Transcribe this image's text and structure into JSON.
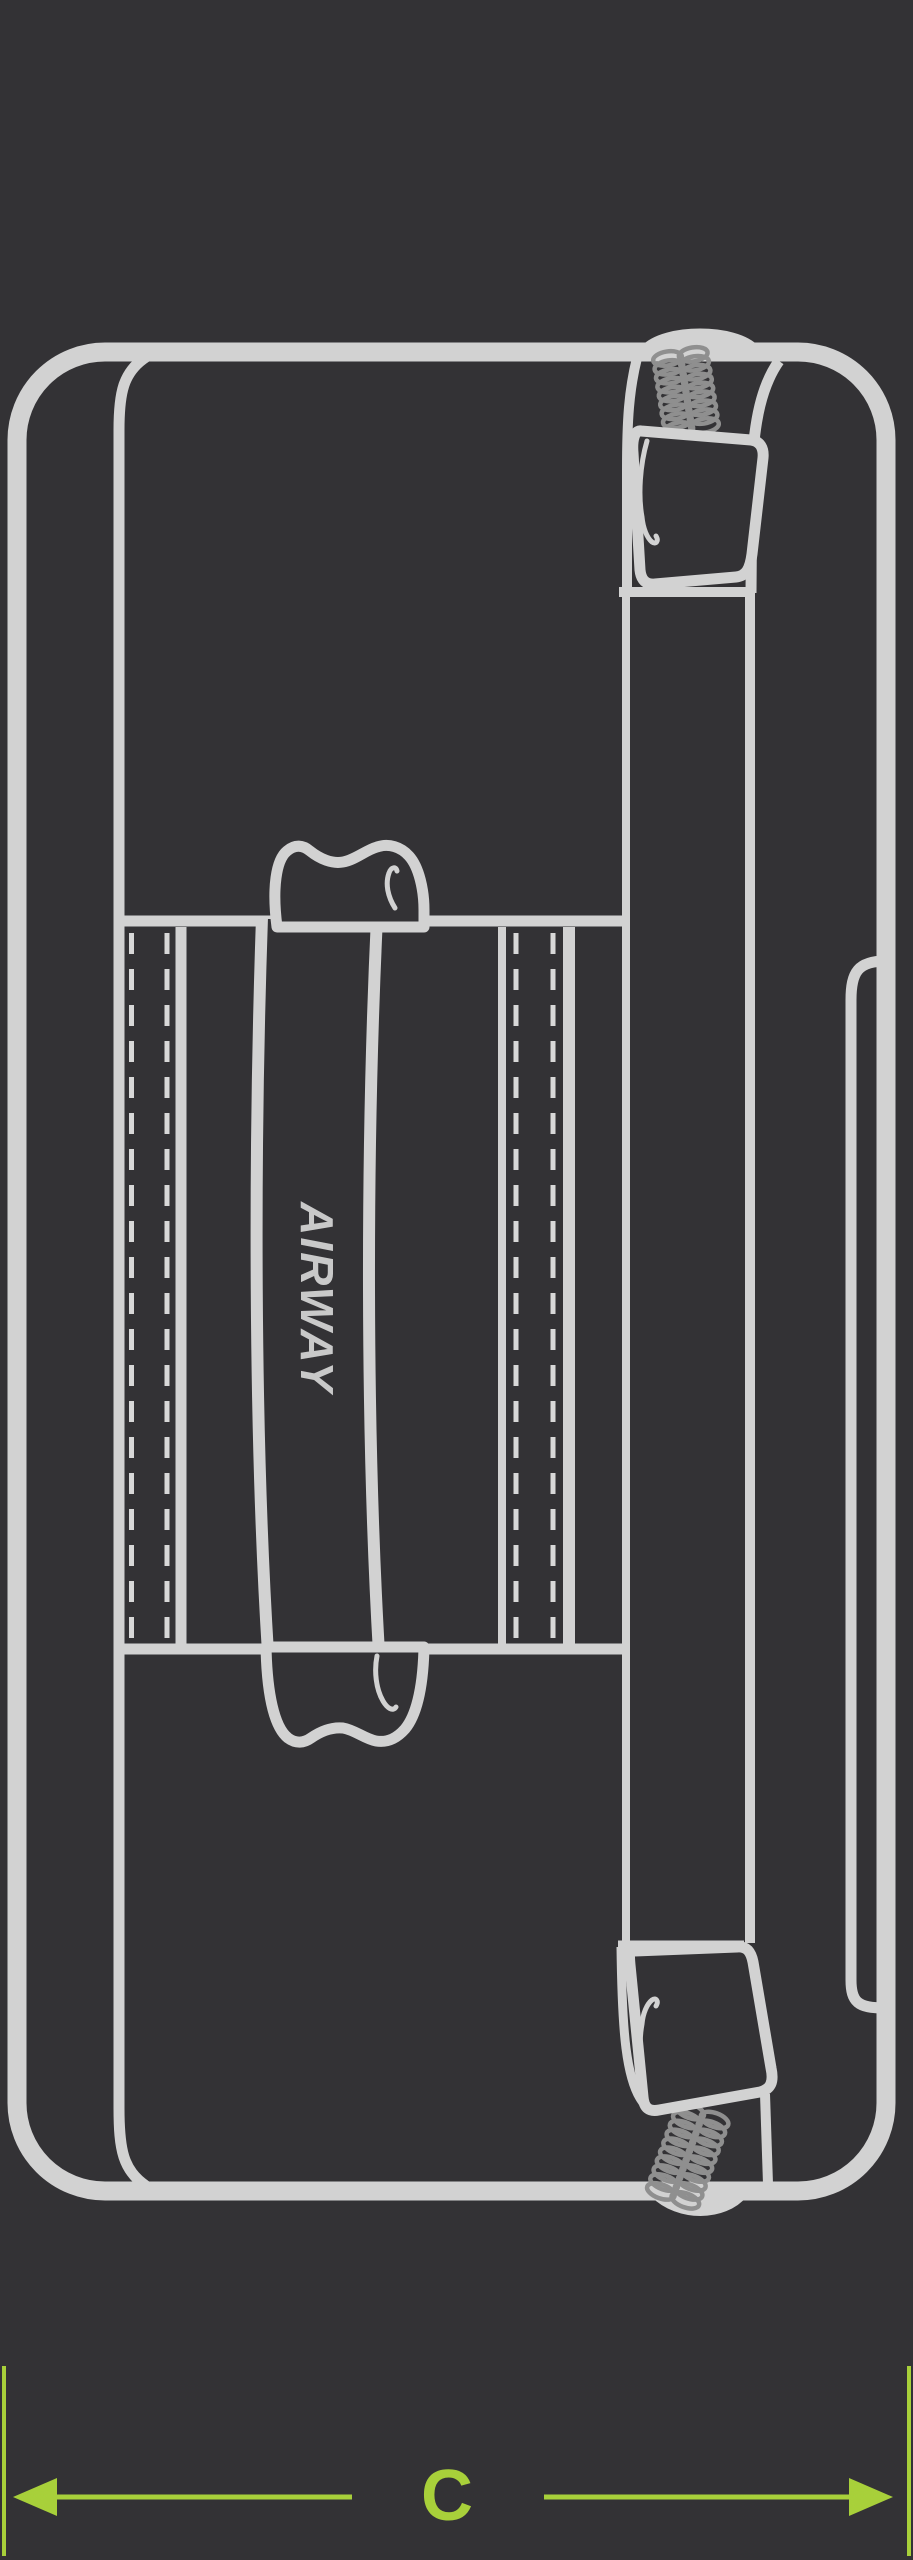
{
  "title": "Duffel bag top view dimension diagram",
  "bag": {
    "handle_label": "AIRWAY"
  },
  "dimension": {
    "label": "C"
  },
  "colors": {
    "background": "#333235",
    "line": "#d2d2d2",
    "stitch": "#d8d8d8",
    "zipper_teeth": "#8f8f8f",
    "accent_green": "#a8d03a",
    "label_gray": "#c9c9c9"
  }
}
